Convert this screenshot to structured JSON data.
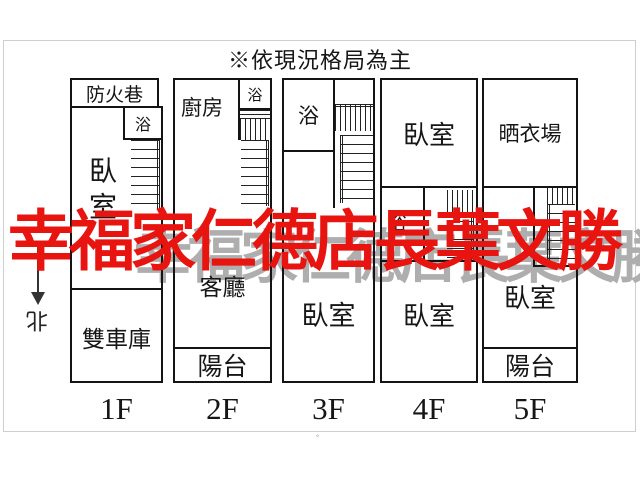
{
  "title": "※依現況格局為主",
  "watermarks": {
    "red": "幸福家仁德店長葉文勝",
    "gray": "幸福家仁德店長葉文勝",
    "red_color": "#e81410",
    "gray_color": "#aeaeae"
  },
  "compass": {
    "north_label": "北"
  },
  "floors": [
    {
      "label": "1F",
      "rooms": {
        "fire_lane": "防火巷",
        "bath": "浴",
        "bedroom": "臥室",
        "garage": "雙車庫"
      }
    },
    {
      "label": "2F",
      "rooms": {
        "kitchen": "廚房",
        "bath": "浴",
        "living_room": "客廳",
        "balcony": "陽台"
      }
    },
    {
      "label": "3F",
      "rooms": {
        "bath": "浴",
        "bedroom": "臥室"
      }
    },
    {
      "label": "4F",
      "rooms": {
        "bedroom_top": "臥室",
        "bath": "浴",
        "bedroom_bottom": "臥室"
      }
    },
    {
      "label": "5F",
      "rooms": {
        "drying_area": "晒衣場",
        "bedroom": "臥室",
        "balcony": "陽台"
      }
    }
  ],
  "footnote_mark": "°",
  "line_color": "#141414"
}
